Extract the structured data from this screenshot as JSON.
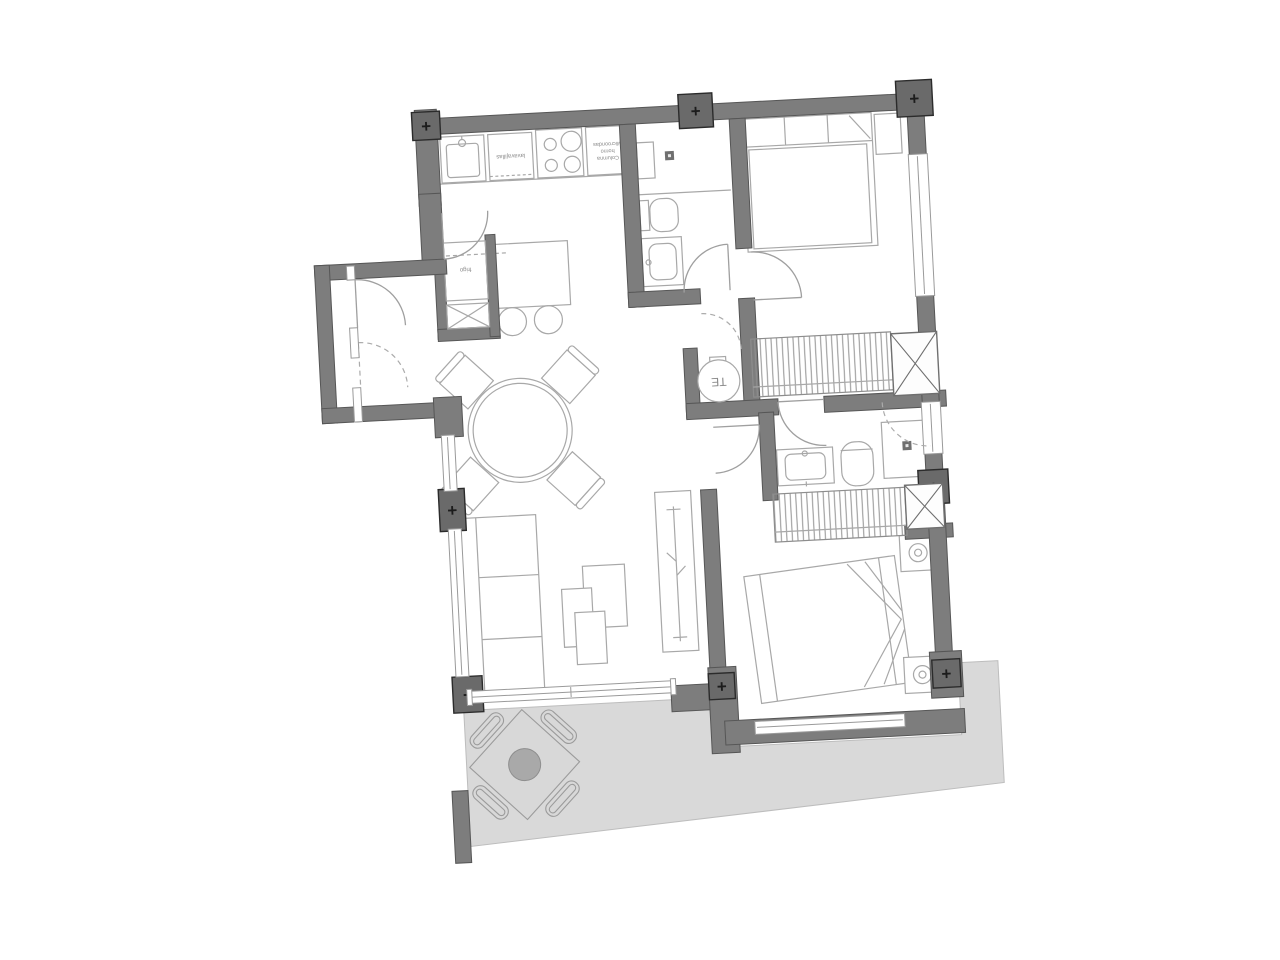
{
  "plan": {
    "type": "apartment-floor-plan",
    "rotation_deg": -3,
    "colors": {
      "wall": "#7d7d7d",
      "column_marker": "#6a6a6a",
      "terrace": "#d9d9d9",
      "furniture_line": "#a8a8a8",
      "hatch": "#909090",
      "label_text": "#8a8a8a",
      "background": "#ffffff"
    },
    "labels": {
      "dishwasher": "lavavajillas",
      "tall_unit_line1": "Microondas",
      "tall_unit_line2": "horno",
      "tall_unit_line3": "Columna",
      "fridge": "frigo",
      "water_heater": "TE"
    },
    "icons": {
      "column_marker": "+"
    }
  }
}
